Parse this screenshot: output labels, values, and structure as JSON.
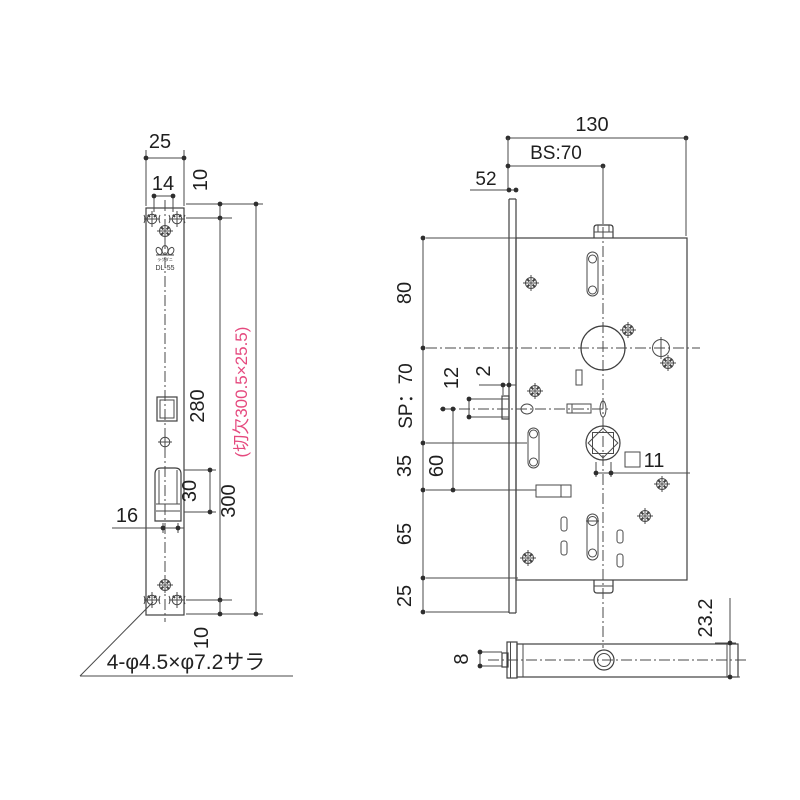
{
  "colors": {
    "line": "#3f3f3f",
    "text": "#1f1f1f",
    "cutout_note_pink": "#e5497e"
  },
  "front_view": {
    "labels": {
      "width": "25",
      "screw_span": "14",
      "top_offset": "10",
      "hole_span": "280",
      "length": "300",
      "latch_height": "30",
      "latch_width": "16",
      "bottom_offset": "10"
    },
    "cutout_note": "(切欠300.5×25.5)",
    "screw_note": "4-φ4.5×φ7.2サラ",
    "brand_text": "ラクダニ",
    "model": "DL-55"
  },
  "side_view": {
    "labels": {
      "case_width": "130",
      "backset": "BS:70",
      "front_edge": "52",
      "top_span": "80",
      "spindle_pitch": "SP：70",
      "offset_12": "12",
      "protrusion": "2",
      "span_60": "60",
      "span_35": "35",
      "square_size": "11",
      "span_65": "65",
      "bottom_span": "25",
      "case_depth": "23.2",
      "latch_thickness": "8"
    }
  }
}
